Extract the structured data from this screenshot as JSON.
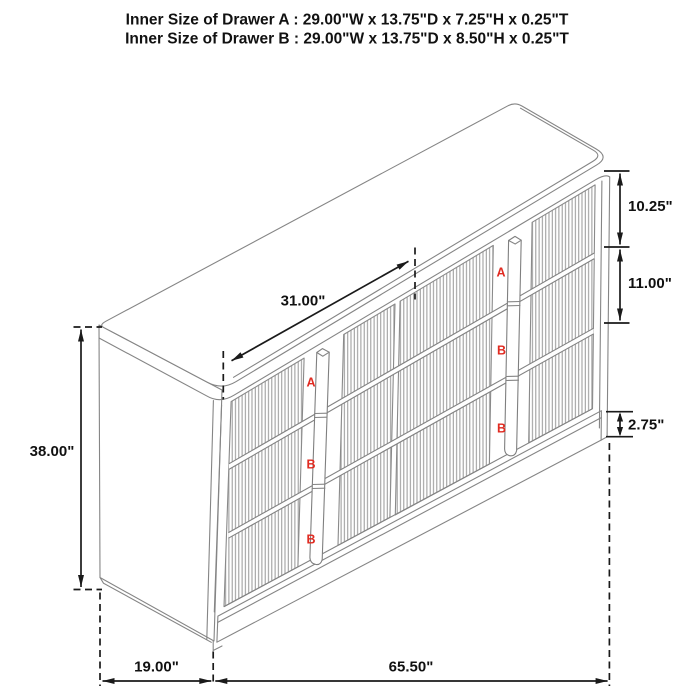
{
  "title": {
    "line1": "Inner Size of Drawer A : 29.00\"W x 13.75\"D x 7.25\"H x 0.25\"T",
    "line2": "Inner Size of Drawer B : 29.00\"W x 13.75\"D x 8.50\"H x 0.25\"T"
  },
  "dimensions": {
    "overall_height": "38.00\"",
    "drawer_front_width": "31.00\"",
    "top_drawer_front_height": "10.25\"",
    "middle_drawer_front_height": "11.00\"",
    "base_height": "2.75\"",
    "overall_depth": "19.00\"",
    "overall_width": "65.50\""
  },
  "drawer_labels": {
    "left_column": [
      "A",
      "B",
      "B"
    ],
    "right_column": [
      "A",
      "B",
      "B"
    ]
  },
  "colors": {
    "drawing_line": "#858585",
    "flute_line": "#979797",
    "dimension_line": "#1a1a1a",
    "drawer_label": "#e02b21",
    "background": "#ffffff"
  }
}
